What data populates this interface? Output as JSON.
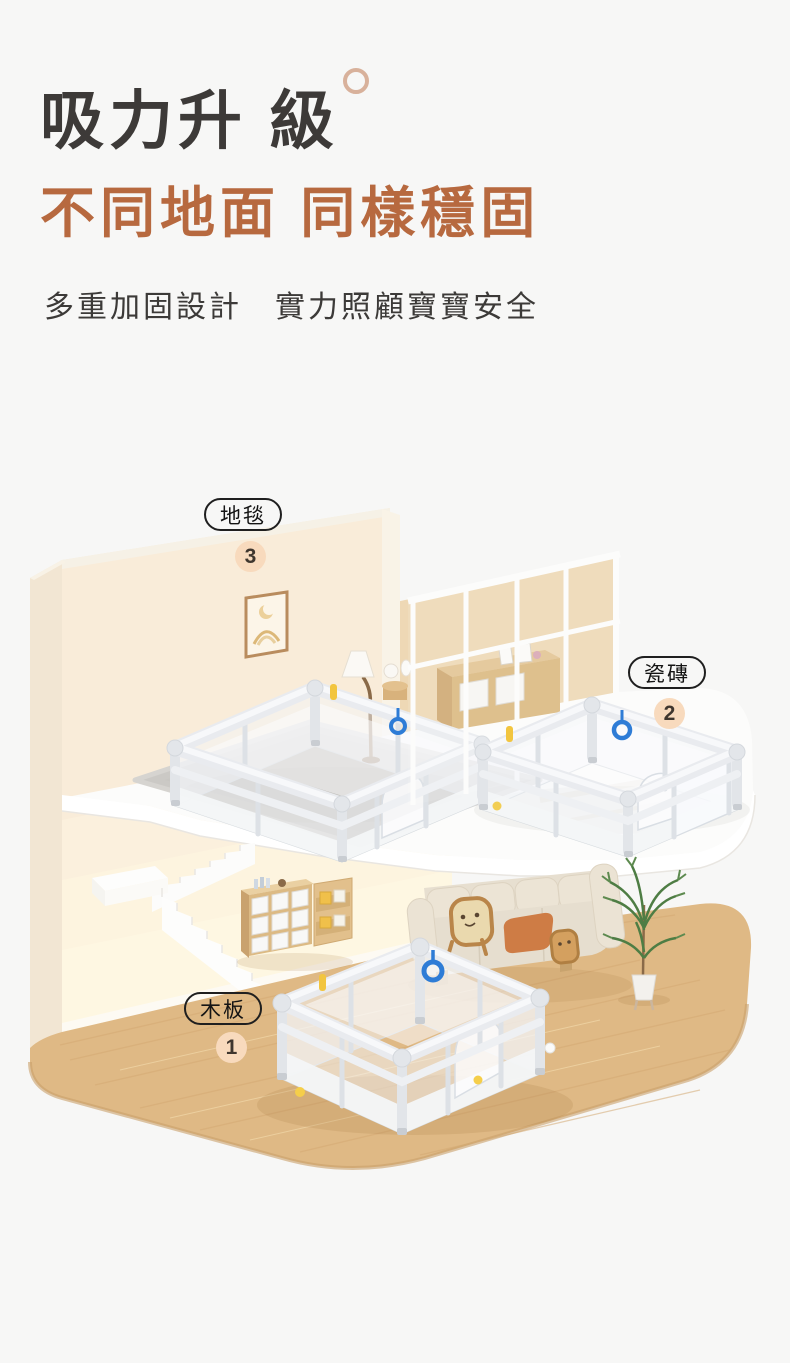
{
  "page": {
    "background_color": "#f7f7f6"
  },
  "header": {
    "title": "吸力升 級",
    "headline": "不同地面 同樣穩固",
    "subtitle": "多重加固設計　實力照顧寶寶安全",
    "title_color": "#3d3a38",
    "accent_color": "#b7693f",
    "ring_color": "#d8b19b"
  },
  "scene": {
    "labels": [
      {
        "id": "carpet",
        "text": "地毯",
        "number": "3"
      },
      {
        "id": "tile",
        "text": "瓷磚",
        "number": "2"
      },
      {
        "id": "wood",
        "text": "木板",
        "number": "1"
      }
    ],
    "badge_background": "#f8dabd",
    "pill_border_color": "#1f1f1f",
    "wall_color": "#f9ecd9",
    "wood_floor_color": "#dfb985",
    "carpet_color": "#cbc9c5",
    "playpen_color": "#e9ebef",
    "pull_ring_color": "#2e7cd6",
    "clip_color": "#f2c53f"
  }
}
